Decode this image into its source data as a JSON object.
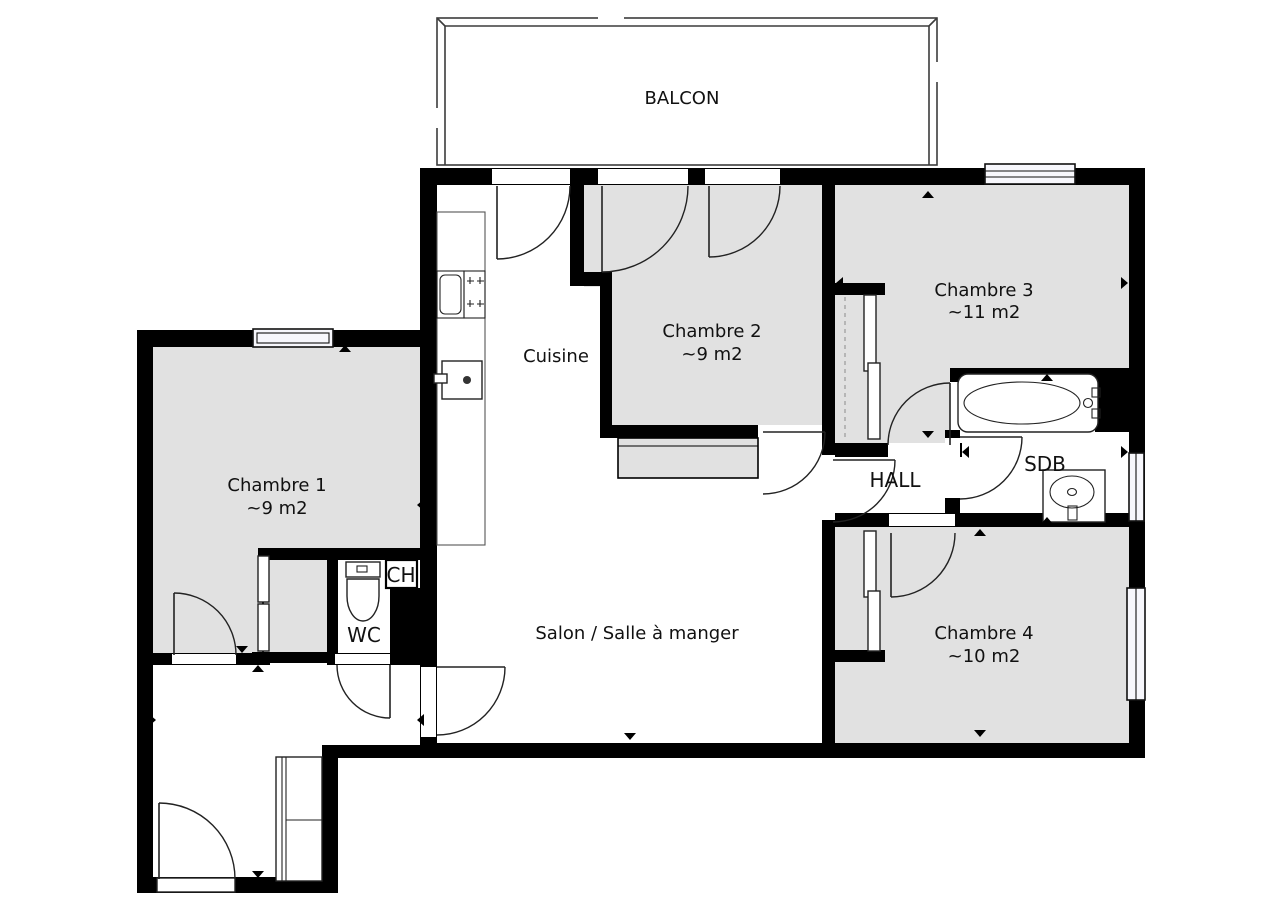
{
  "plan": {
    "title": "Floor plan",
    "balcon": {
      "label": "BALCON"
    },
    "rooms": {
      "chambre1": {
        "label": "Chambre 1",
        "area": "~9 m2"
      },
      "chambre2": {
        "label": "Chambre 2",
        "area": "~9 m2"
      },
      "chambre3": {
        "label": "Chambre 3",
        "area": "~11 m2"
      },
      "chambre4": {
        "label": "Chambre 4",
        "area": "~10 m2"
      },
      "cuisine": {
        "label": "Cuisine"
      },
      "salon": {
        "label": "Salon / Salle à manger"
      },
      "hall": {
        "label": "HALL"
      },
      "sdb": {
        "label": "SDB"
      },
      "wc": {
        "label": "WC"
      },
      "ch": {
        "label": "CH"
      }
    },
    "colors": {
      "wall": "#000000",
      "room_fill": "#e1e1e1",
      "background": "#ffffff",
      "window_fill": "#f7f7fc"
    }
  }
}
